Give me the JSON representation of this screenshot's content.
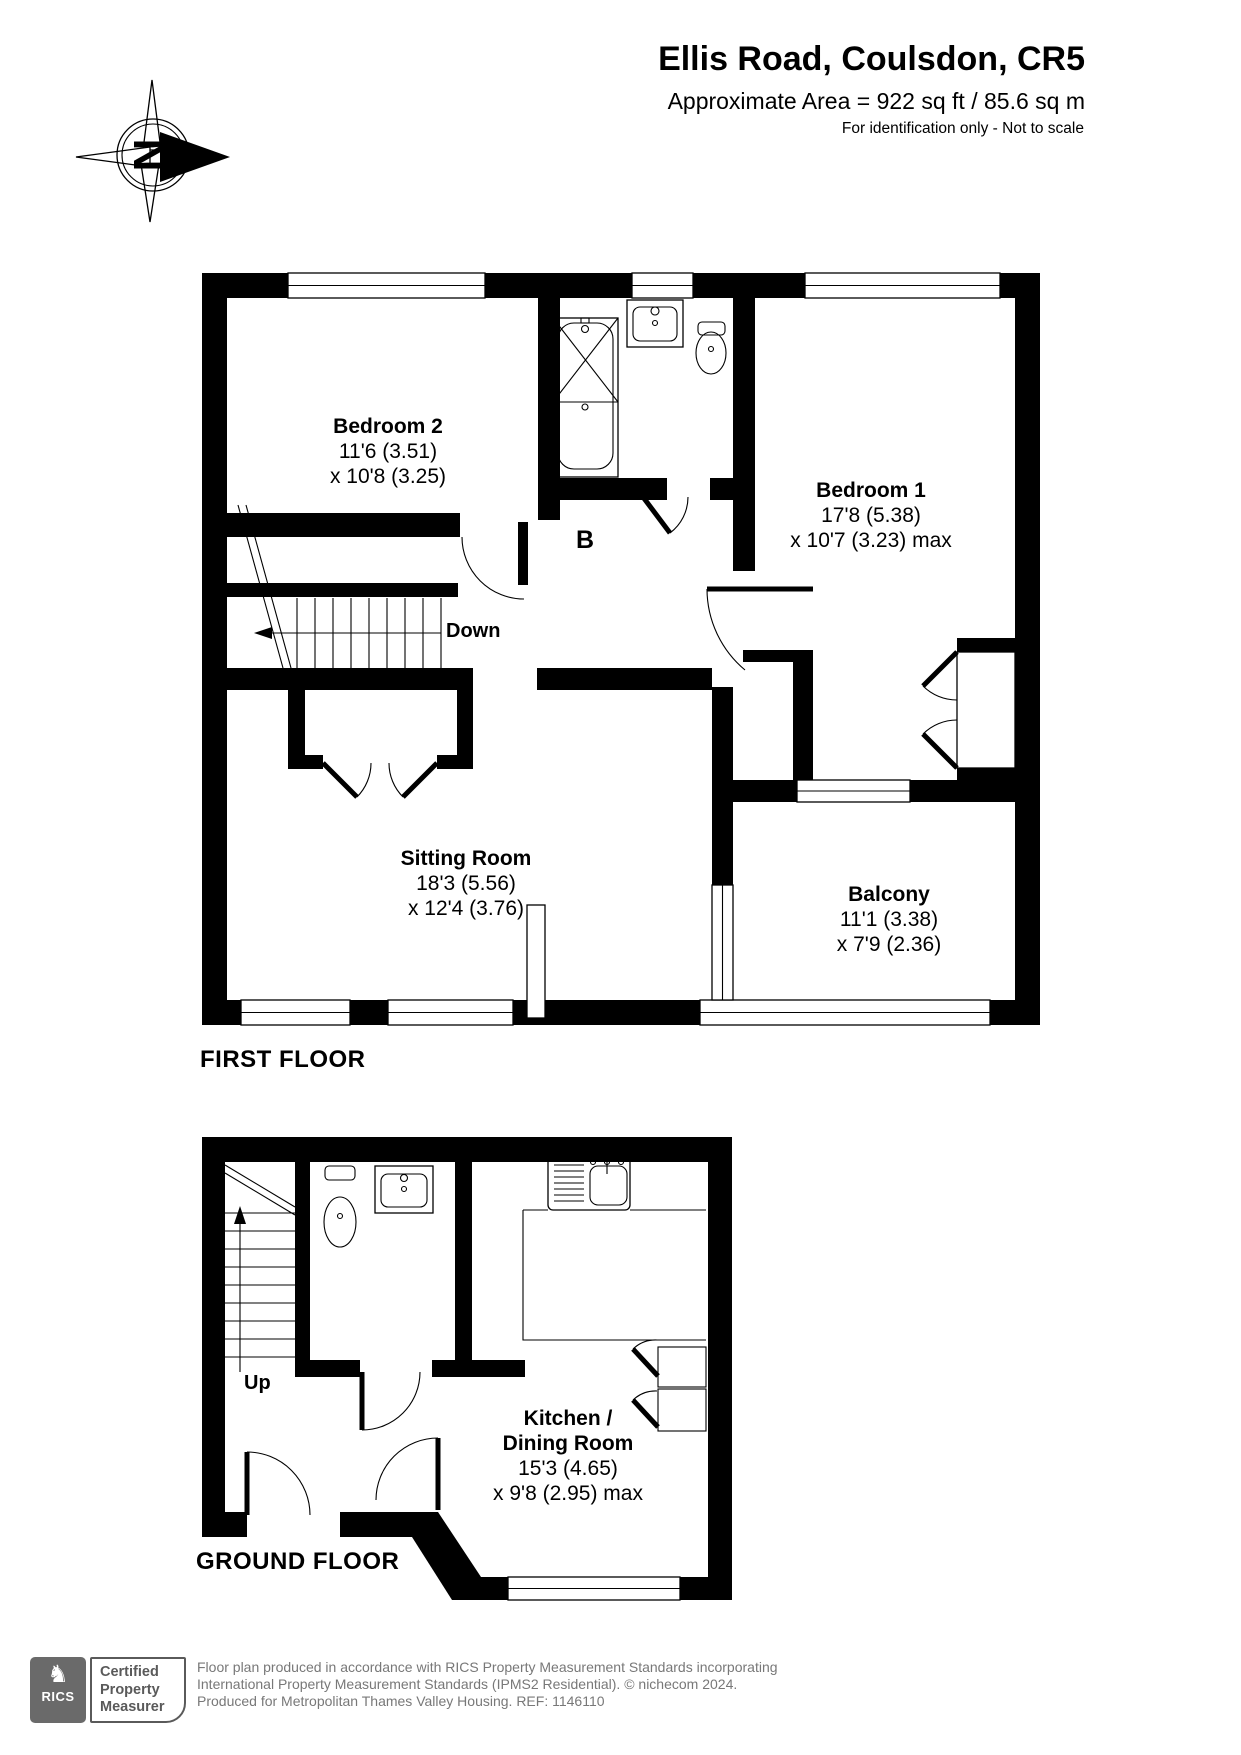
{
  "header": {
    "title": "Ellis Road, Coulsdon, CR5",
    "area_line": "Approximate Area = 922 sq ft / 85.6 sq m",
    "disclaimer": "For identification only - Not to scale",
    "compass_letter": "N"
  },
  "first_floor": {
    "floor_label": "FIRST FLOOR",
    "stairs_label": "Down",
    "bathroom_label": "B",
    "rooms": {
      "bedroom2": {
        "name": "Bedroom 2",
        "dim1": "11'6 (3.51)",
        "dim2": "x 10'8 (3.25)"
      },
      "bedroom1": {
        "name": "Bedroom 1",
        "dim1": "17'8 (5.38)",
        "dim2": "x 10'7 (3.23) max"
      },
      "sitting_room": {
        "name": "Sitting Room",
        "dim1": "18'3 (5.56)",
        "dim2": "x 12'4 (3.76)"
      },
      "balcony": {
        "name": "Balcony",
        "dim1": "11'1 (3.38)",
        "dim2": "x 7'9 (2.36)"
      }
    }
  },
  "ground_floor": {
    "floor_label": "GROUND FLOOR",
    "stairs_label": "Up",
    "rooms": {
      "kitchen": {
        "name1": "Kitchen /",
        "name2": "Dining Room",
        "dim1": "15'3 (4.65)",
        "dim2": "x 9'8 (2.95) max"
      }
    }
  },
  "footer": {
    "rics_logo_text": "RICS",
    "badge_lines": [
      "Certified",
      "Property",
      "Measurer"
    ],
    "line1": "Floor plan produced in accordance with RICS Property Measurement Standards incorporating",
    "line2": "International Property Measurement Standards (IPMS2 Residential).   © nichecom 2024.",
    "line3": "Produced for Metropolitan Thames Valley Housing.   REF: 1146110"
  },
  "colors": {
    "wall": "#000000",
    "footer_text": "#787878",
    "logo_gray": "#6a6a6a"
  }
}
